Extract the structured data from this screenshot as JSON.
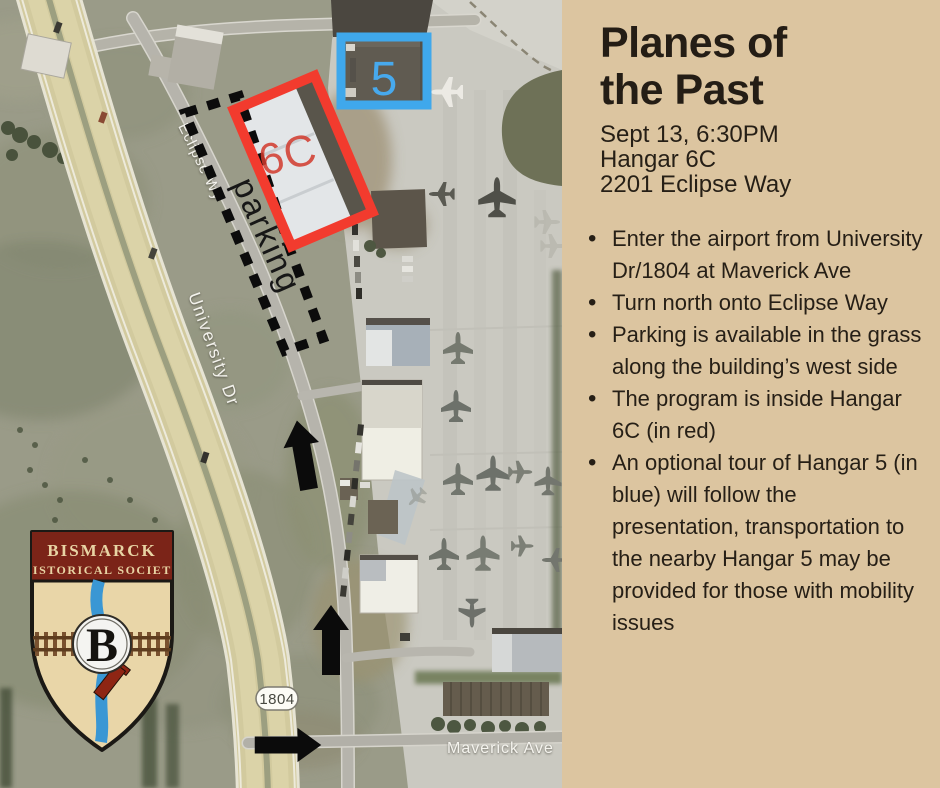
{
  "panel": {
    "title_line1": "Planes of",
    "title_line2": "the Past",
    "date": "Sept 13, 6:30PM",
    "venue": "Hangar 6C",
    "address": "2201 Eclipse Way",
    "bullets": [
      "Enter the airport from University Dr/1804 at Maverick Ave",
      "Turn north onto Eclipse Way",
      "Parking is available in the grass along the building’s west side",
      "The program is inside Hangar 6C (in red)",
      "An optional tour of Hangar 5 (in blue) will follow the presentation, transportation to the nearby Hangar 5 may be provided for those with mobility issues"
    ],
    "background_color": "#dcc5a0",
    "text_color": "#261f16"
  },
  "map": {
    "hangar5_label": "5",
    "hangar6c_label": "6C",
    "parking_label": "parking",
    "road_eclipse": "Eclipse Wy",
    "road_university": "University Dr",
    "road_maverick": "Maverick Ave",
    "route_shield": "1804",
    "highlight_blue": "#3fa8ec",
    "highlight_red": "#f23b2e",
    "arrow_color": "#0b0b0b"
  },
  "logo": {
    "org_line1": "BISMARCK",
    "org_line2": "HISTORICAL SOCIETY",
    "monogram": "B",
    "banner_color": "#7b2418",
    "shield_color": "#e9d6a8"
  }
}
